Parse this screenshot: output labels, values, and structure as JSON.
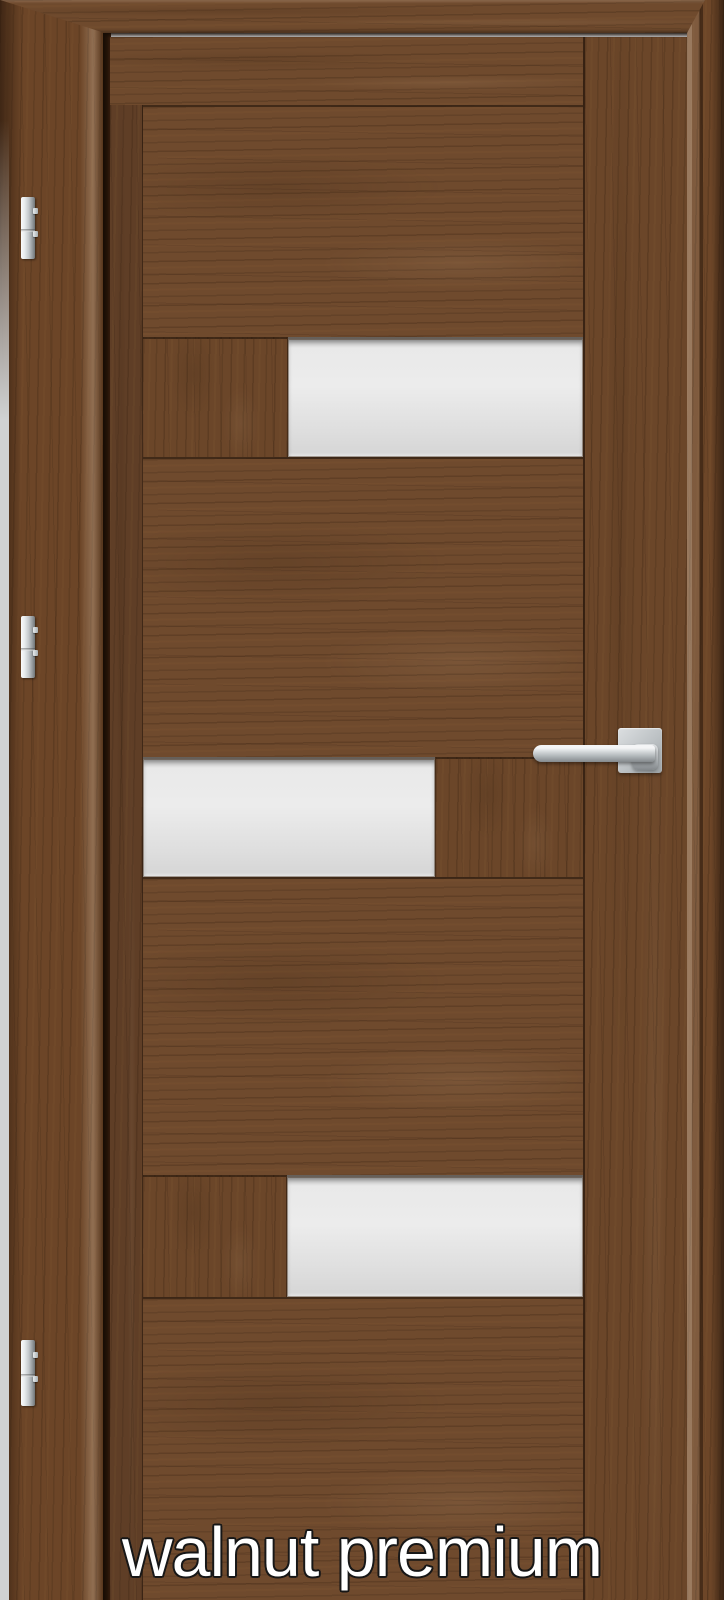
{
  "caption": {
    "text": "walnut premium"
  },
  "palette": {
    "background": "#d3d4d5",
    "wood_base": "#6f4a2d",
    "wood_dark_streak": "#472c18",
    "wood_light_streak": "#8d6239",
    "frame_edge_dark": "#2e1a0c",
    "glass": "#e7e7e7",
    "hardware_silver": "#c9cdd0",
    "caption_fill": "#ffffff",
    "caption_outline": "#171717"
  },
  "door": {
    "glass_pane_count": 3,
    "hinge_count": 3,
    "hardware": {
      "handle": "lever handle on square rosette",
      "hinges": "barrel hinges"
    }
  }
}
